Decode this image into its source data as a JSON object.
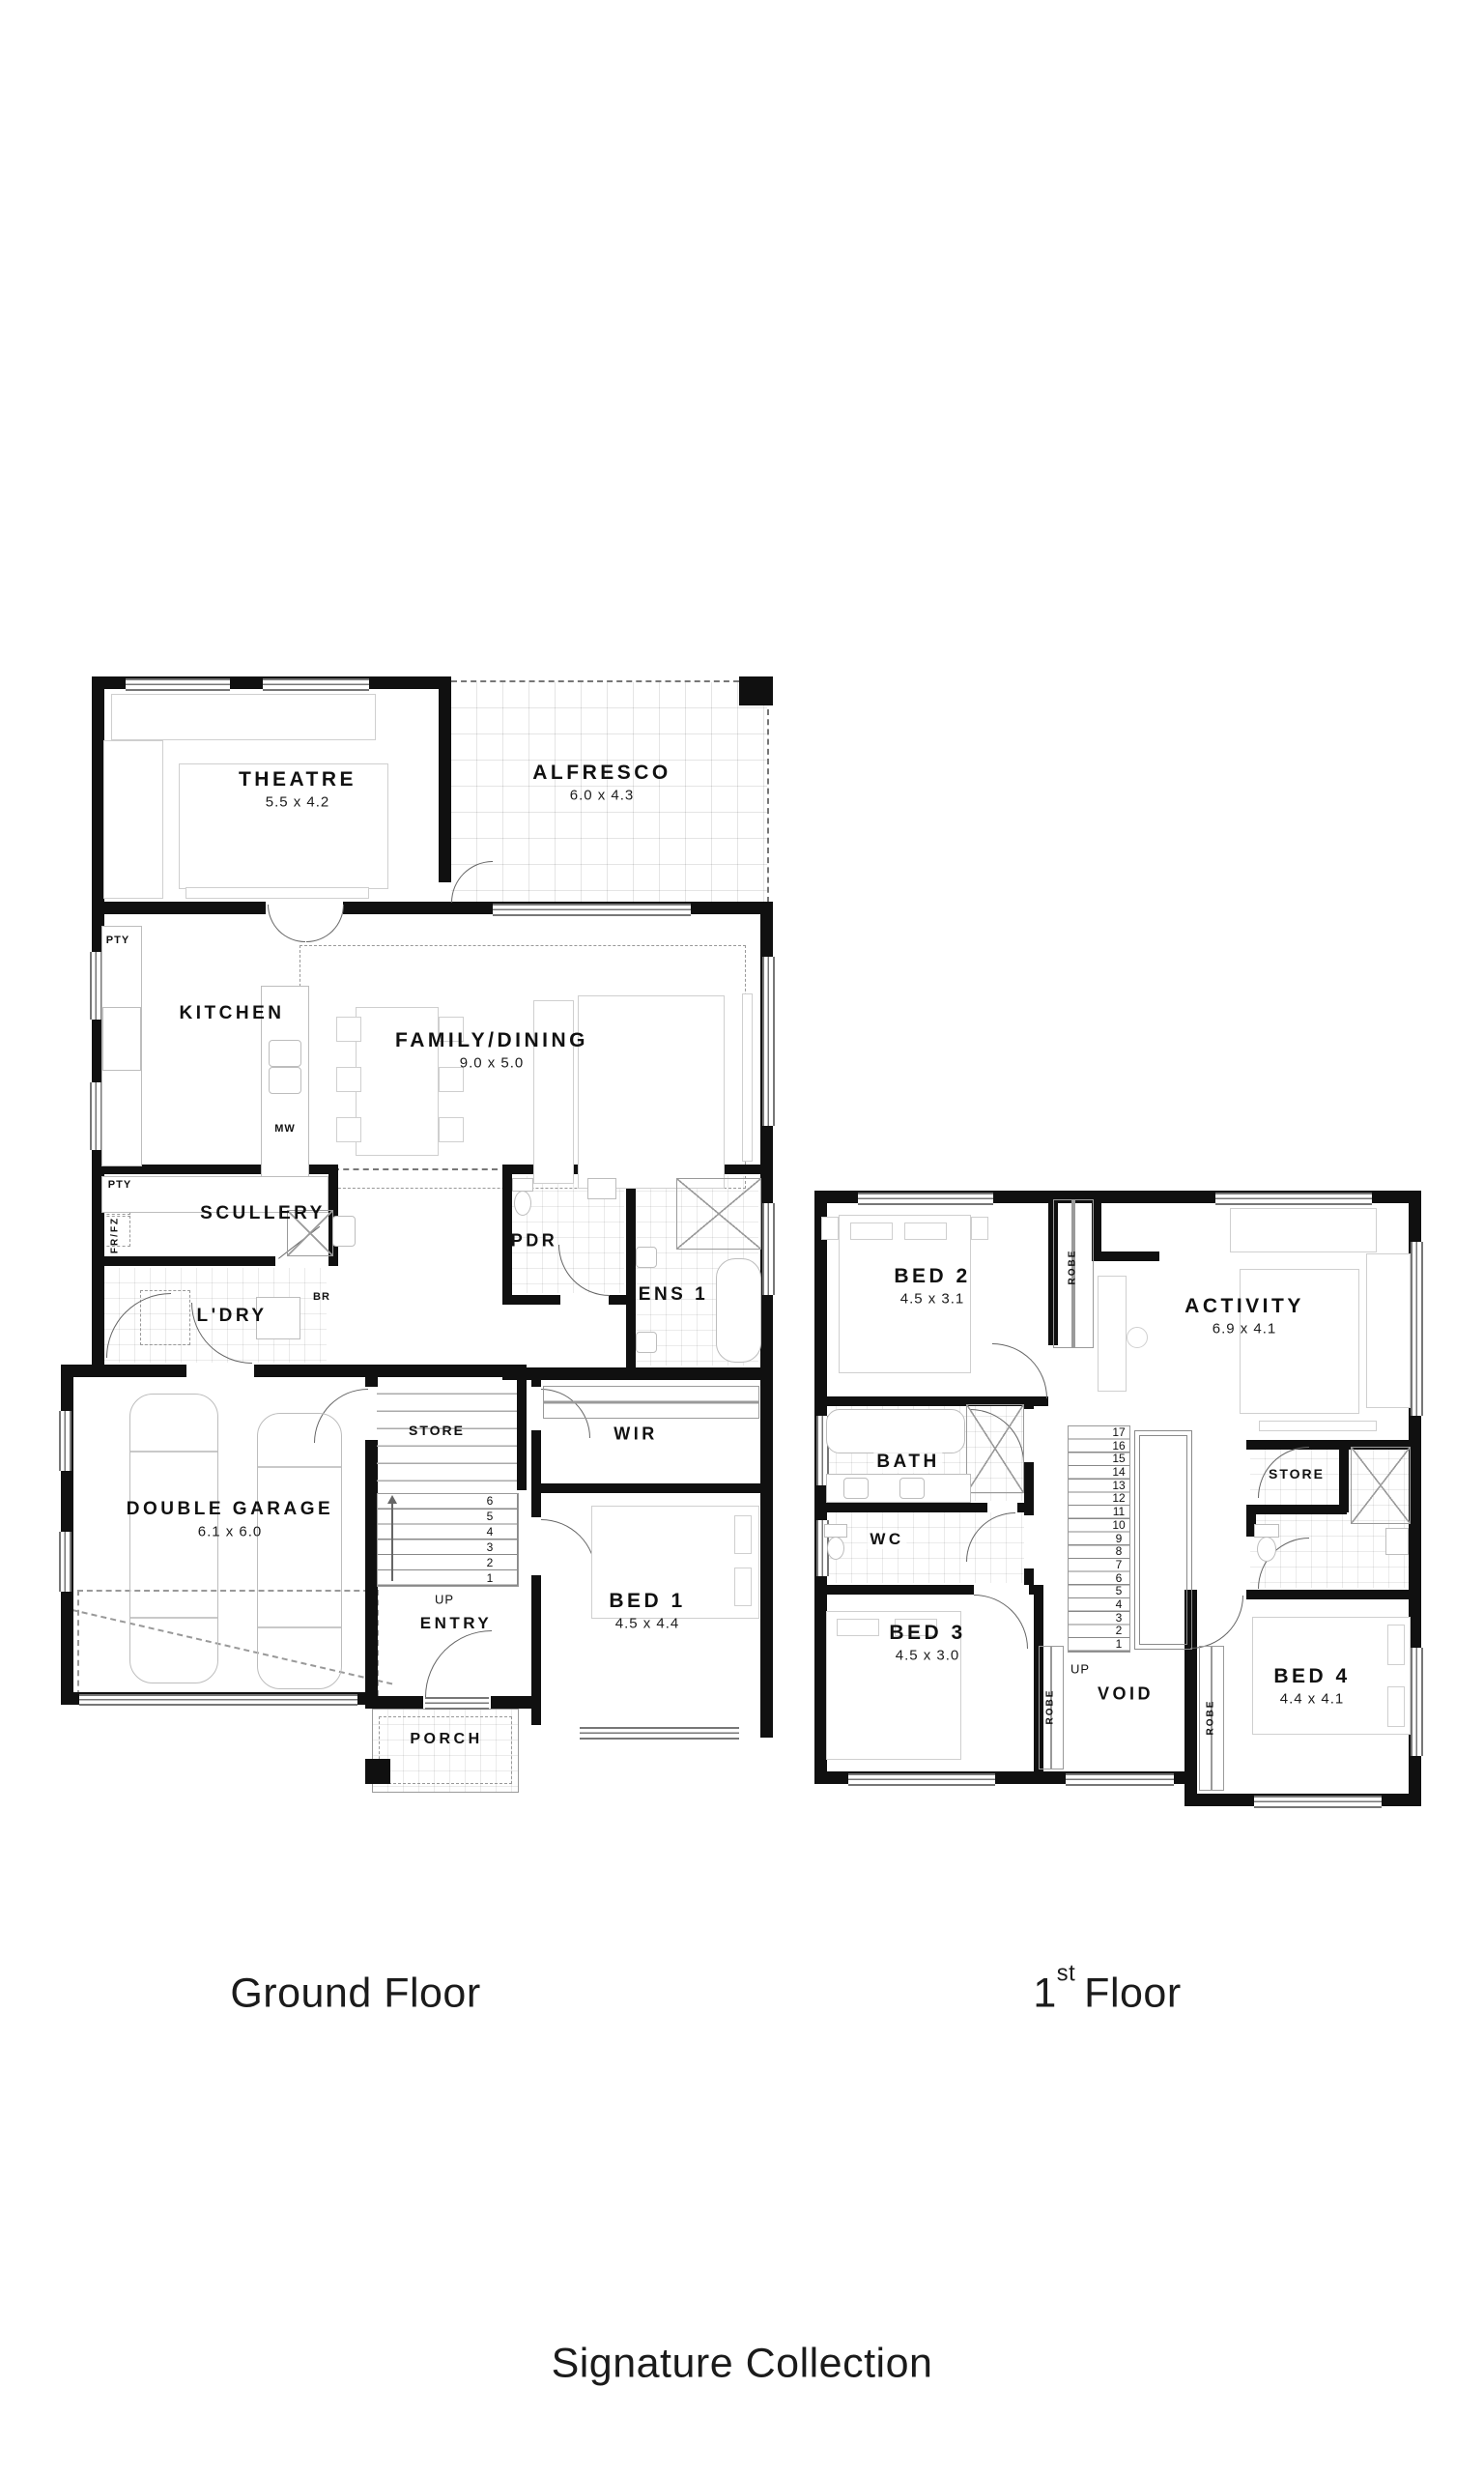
{
  "palette": {
    "wall": "#101010",
    "thin_line": "#888888",
    "furniture_line": "#bdbdbd",
    "text": "#111111",
    "background": "#ffffff"
  },
  "floors": {
    "ground": {
      "caption": "Ground Floor",
      "rooms": {
        "theatre": {
          "name": "THEATRE",
          "dims": "5.5 x 4.2"
        },
        "alfresco": {
          "name": "ALFRESCO",
          "dims": "6.0 x 4.3"
        },
        "kitchen": {
          "name": "KITCHEN"
        },
        "family_dining": {
          "name": "FAMILY/DINING",
          "dims": "9.0 x 5.0"
        },
        "scullery": {
          "name": "SCULLERY"
        },
        "pdr": {
          "name": "PDR"
        },
        "ens1": {
          "name": "ENS 1"
        },
        "ldry": {
          "name": "L'DRY"
        },
        "double_garage": {
          "name": "DOUBLE GARAGE",
          "dims": "6.1 x 6.0"
        },
        "store": {
          "name": "STORE"
        },
        "wir": {
          "name": "WIR"
        },
        "entry": {
          "name": "ENTRY"
        },
        "bed1": {
          "name": "BED 1",
          "dims": "4.5 x 4.4"
        },
        "porch": {
          "name": "PORCH"
        }
      },
      "annotations": {
        "pty1": "PTY",
        "pty2": "PTY",
        "frfz": "FR/FZ",
        "mw": "MW",
        "br": "BR",
        "up": "UP"
      },
      "stairs": [
        "6",
        "5",
        "4",
        "3",
        "2",
        "1"
      ]
    },
    "first": {
      "caption_num": "1",
      "caption_sup": "st",
      "caption_word": "Floor",
      "rooms": {
        "bed2": {
          "name": "BED 2",
          "dims": "4.5 x 3.1"
        },
        "activity": {
          "name": "ACTIVITY",
          "dims": "6.9 x 4.1"
        },
        "bath": {
          "name": "BATH"
        },
        "store": {
          "name": "STORE"
        },
        "wc": {
          "name": "WC"
        },
        "bed3": {
          "name": "BED 3",
          "dims": "4.5 x 3.0"
        },
        "void": {
          "name": "VOID"
        },
        "bed4": {
          "name": "BED 4",
          "dims": "4.4 x 4.1"
        }
      },
      "annotations": {
        "robe_bed2": "ROBE",
        "robe_bed3": "ROBE",
        "robe_bed4": "ROBE",
        "up": "UP"
      },
      "stairs": [
        "17",
        "16",
        "15",
        "14",
        "13",
        "12",
        "11",
        "10",
        "9",
        "8",
        "7",
        "6",
        "5",
        "4",
        "3",
        "2",
        "1"
      ]
    }
  },
  "footer": {
    "collection": "Signature Collection"
  }
}
